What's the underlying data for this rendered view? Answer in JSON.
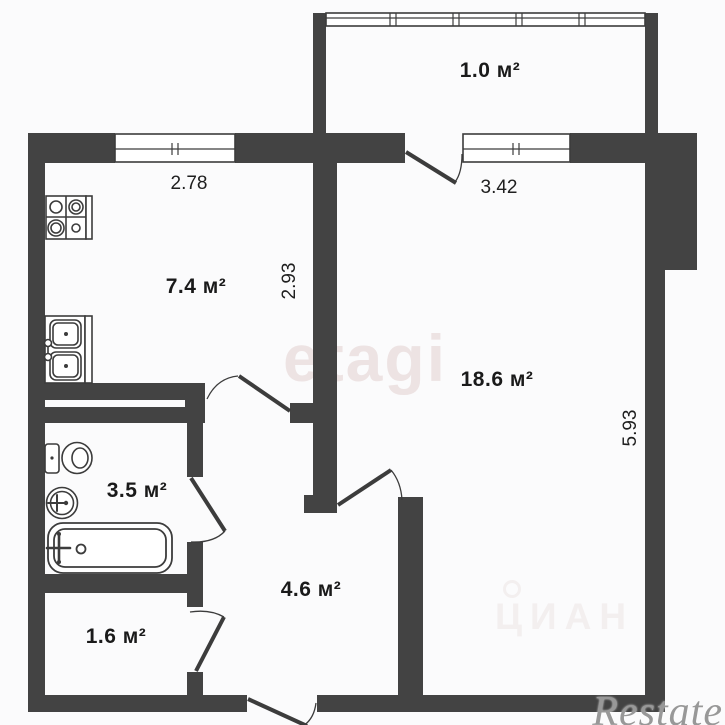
{
  "plan_type": "apartment-floor-plan",
  "rooms": {
    "balcony": {
      "label": "1.0 м²"
    },
    "kitchen": {
      "label": "7.4 м²"
    },
    "living": {
      "label": "18.6 м²"
    },
    "bathroom": {
      "label": "3.5 м²"
    },
    "hallway": {
      "label": "4.6 м²"
    },
    "storage": {
      "label": "1.6 м²"
    }
  },
  "dimensions": {
    "kitchen_width": "2.78",
    "kitchen_depth": "2.93",
    "living_width": "3.42",
    "living_depth": "5.93"
  },
  "watermarks": {
    "etagi": "etagi",
    "cian": "ЦИАН",
    "restate": "Restate"
  },
  "fixtures": [
    "stove-icon",
    "kitchen-sink-icon",
    "toilet-icon",
    "wash-basin-icon",
    "bathtub-icon"
  ],
  "colors": {
    "wall": "#434343",
    "line": "#3c3c3c",
    "label_text": "#1a1a1a",
    "watermark_pink": "#ede3e3",
    "watermark_gray": "#989898"
  }
}
